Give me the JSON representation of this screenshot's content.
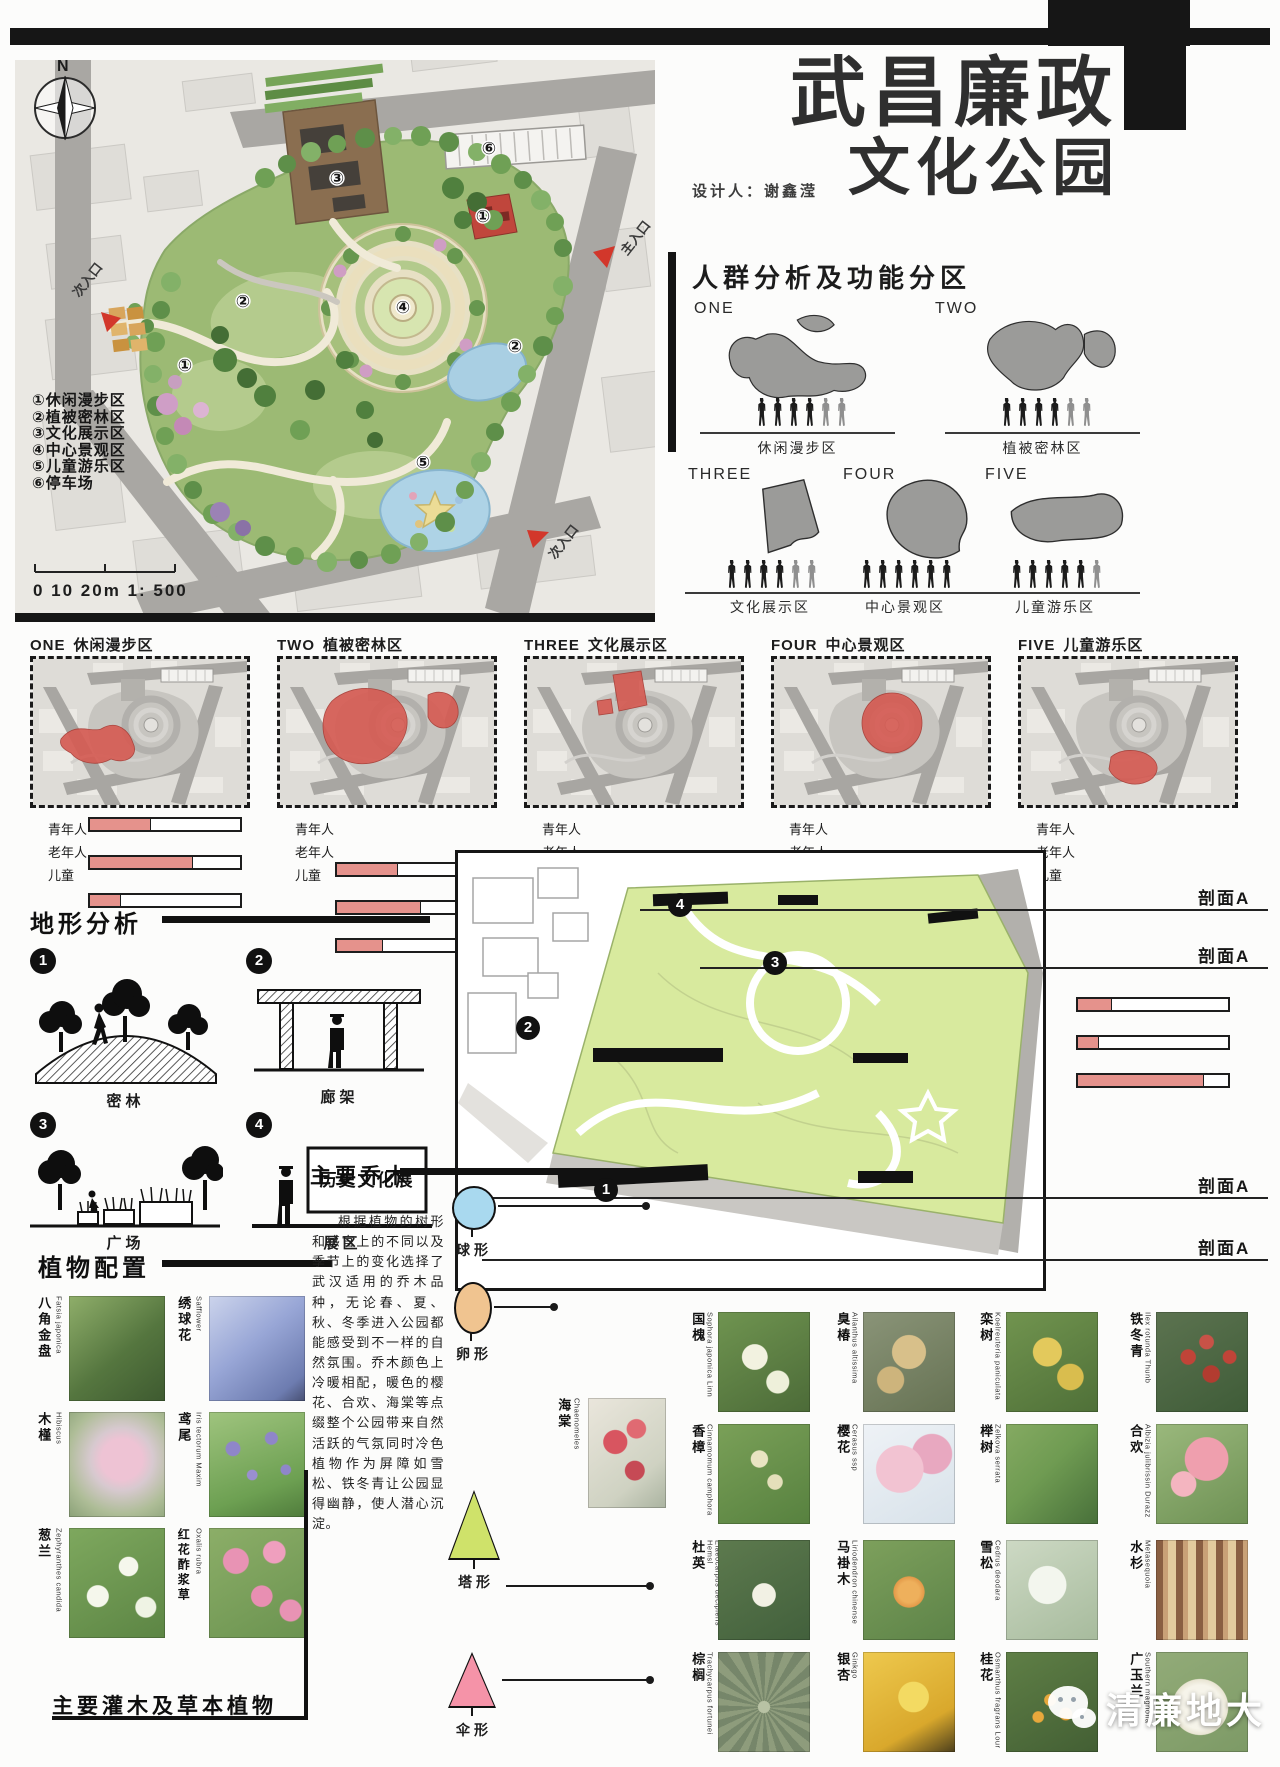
{
  "header": {
    "title_line1": "武昌廉政",
    "title_line2": "文化公园",
    "designer": "设计人：谢鑫滢"
  },
  "site_plan": {
    "north_label": "N",
    "legend": [
      "①休闲漫步区",
      "②植被密林区",
      "③文化展示区",
      "④中心景观区",
      "⑤儿童游乐区",
      "⑥停车场"
    ],
    "scale": "0  10  20m 1: 500",
    "entrances": [
      "次入口",
      "主入口",
      "次入口"
    ],
    "markers": [
      "③",
      "⑥",
      "①",
      "④",
      "②",
      "②",
      "①",
      "⑤"
    ]
  },
  "crowd": {
    "title": "人群分析及功能分区"
  },
  "zones": [
    {
      "id": "ONE",
      "name": "休闲漫步区",
      "bars": [
        {
          "label": "青年人",
          "width": "40%"
        },
        {
          "label": "老年人",
          "width": "68%"
        },
        {
          "label": "儿童",
          "width": "20%"
        }
      ]
    },
    {
      "id": "TWO",
      "name": "植被密林区",
      "bars": [
        {
          "label": "青年人",
          "width": "40%"
        },
        {
          "label": "老年人",
          "width": "55%"
        },
        {
          "label": "儿童",
          "width": "30%"
        }
      ]
    },
    {
      "id": "THREE",
      "name": "文化展示区",
      "bars": [
        {
          "label": "青年人",
          "width": "57%"
        },
        {
          "label": "老年人",
          "width": "43%"
        },
        {
          "label": "儿童",
          "width": "25%"
        }
      ]
    },
    {
      "id": "FOUR",
      "name": "中心景观区",
      "bars": [
        {
          "label": "青年人",
          "width": "67%"
        },
        {
          "label": "老年人",
          "width": "30%"
        },
        {
          "label": "儿童",
          "width": "52%"
        }
      ]
    },
    {
      "id": "FIVE",
      "name": "儿童游乐区",
      "bars": [
        {
          "label": "青年人",
          "width": "22%"
        },
        {
          "label": "老年人",
          "width": "13%"
        },
        {
          "label": "儿童",
          "width": "83%"
        }
      ]
    }
  ],
  "terrain": {
    "title": "地形分析",
    "items": [
      {
        "num": "1",
        "label": "密林"
      },
      {
        "num": "2",
        "label": "廊架"
      },
      {
        "num": "3",
        "label": "广场"
      },
      {
        "num": "4",
        "label": "展区"
      }
    ],
    "sign": "历史文化展"
  },
  "axon": {
    "section_label": "剖面A",
    "markers": [
      "1",
      "2",
      "3",
      "4"
    ]
  },
  "planting": {
    "title": "植物配置",
    "main_trees_title": "主要乔木",
    "description": "根据植物的树形和感官上的不同以及季节上的变化选择了武汉适用的乔木品种，无论春、夏、秋、冬季进入公园都能感受到不一样的自然氛围。乔木颜色上冷暖相配，暖色的樱花、合欢、海棠等点缀整个公园带来自然活跃的气氛同时冷色植物作为屏障如雪松、铁冬青让公园显得幽静，使人潜心沉淀。",
    "shrubs_title": "主要灌木及草本植物",
    "tree_shapes": [
      {
        "label": "球形",
        "color": "#a9d9ef"
      },
      {
        "label": "卵形",
        "color": "#f0c490"
      },
      {
        "label": "塔形",
        "color": "#cfe26a"
      },
      {
        "label": "伞形",
        "color": "#f593a8"
      }
    ],
    "left_plants": [
      {
        "cn": "八角金盘",
        "latin": "Fatsia japonica"
      },
      {
        "cn": "绣球花",
        "latin": "Safflower"
      },
      {
        "cn": "木槿",
        "latin": "Hibiscus"
      },
      {
        "cn": "鸢尾",
        "latin": "Iris tectorum Maxim"
      },
      {
        "cn": "葱兰",
        "latin": "Zephyranthes candida"
      },
      {
        "cn": "红花酢浆草",
        "latin": "Oxalis rubra"
      }
    ],
    "accent_plant": {
      "cn": "海棠",
      "latin": "Chaenomeles"
    },
    "right_plants": [
      {
        "cn": "国槐",
        "latin": "Sophora japonica Linn"
      },
      {
        "cn": "臭椿",
        "latin": "Ailanthus altissima"
      },
      {
        "cn": "栾树",
        "latin": "Koelreuteria paniculata"
      },
      {
        "cn": "铁冬青",
        "latin": "Ilex rotunda Thunb"
      },
      {
        "cn": "香樟",
        "latin": "Cinnamomum camphora"
      },
      {
        "cn": "樱花",
        "latin": "Cerasus ssp"
      },
      {
        "cn": "榉树",
        "latin": "Zelkova serrata"
      },
      {
        "cn": "合欢",
        "latin": "Albizia julibrissin Durazz"
      },
      {
        "cn": "杜英",
        "latin": "Elaeocarpus decipiens Hemsl"
      },
      {
        "cn": "马褂木",
        "latin": "Liriodendron chinense"
      },
      {
        "cn": "雪松",
        "latin": "Cedrus deodara"
      },
      {
        "cn": "水杉",
        "latin": "Metasequoia"
      },
      {
        "cn": "棕榈",
        "latin": "Trachycarpus fortunei"
      },
      {
        "cn": "银杏",
        "latin": "Ginkgo"
      },
      {
        "cn": "桂花",
        "latin": "Osmanthus fragrans Lour"
      },
      {
        "cn": "广玉兰",
        "latin": "Southern magnolia"
      }
    ]
  },
  "watermark": {
    "text": "清廉地大"
  },
  "colors": {
    "accent_red": "#d65a52",
    "bar_fill": "#e5928c",
    "park_green": "#9cba74"
  }
}
